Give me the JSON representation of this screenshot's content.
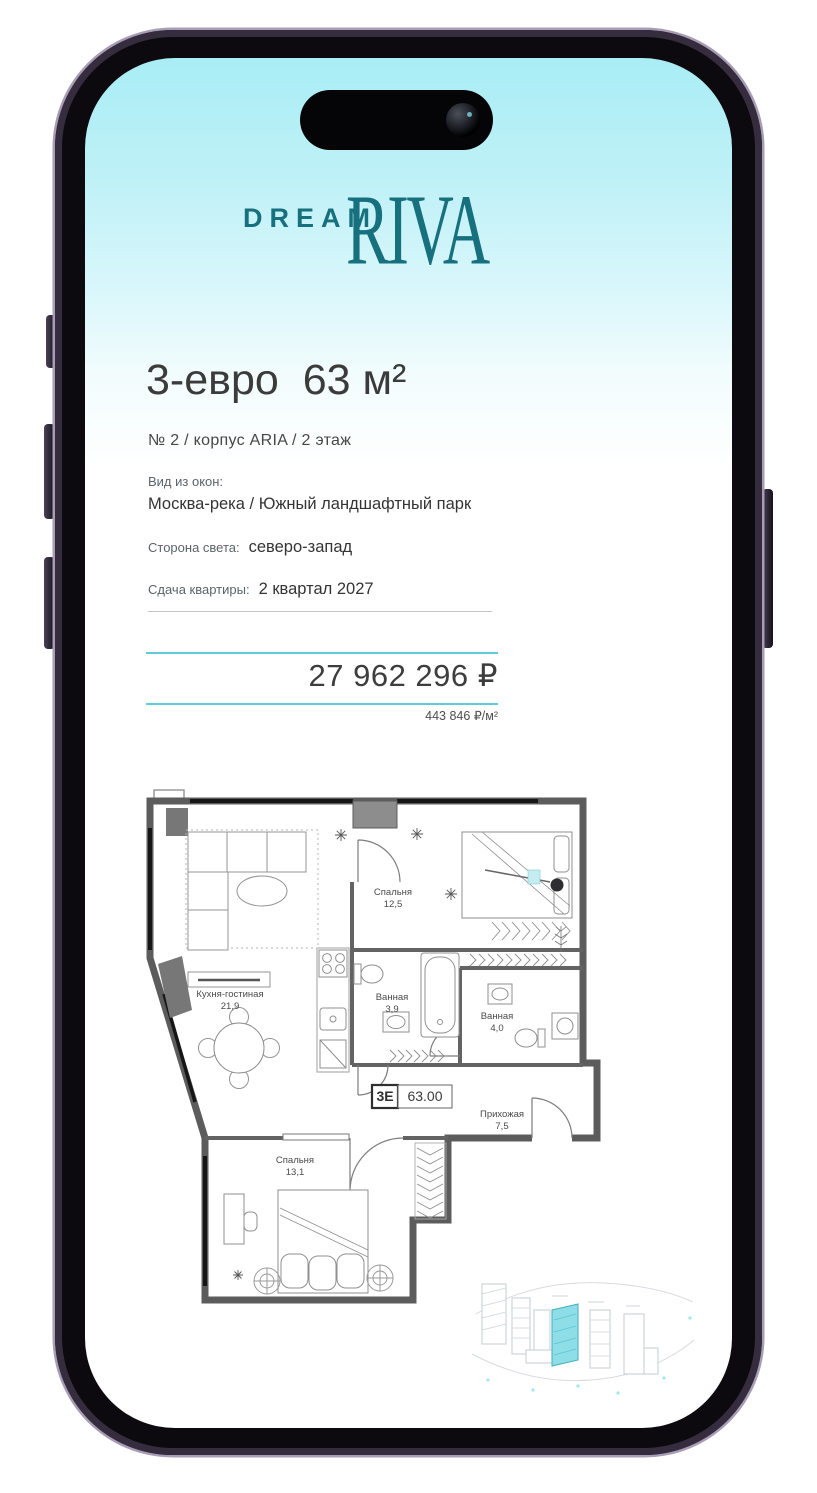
{
  "logo": {
    "dream": "DREAM",
    "riva": "RIVA"
  },
  "listing": {
    "title": "3-евро  63 м²",
    "subtitle": "№ 2 / корпус ARIA / 2 этаж",
    "view_label": "Вид из окон:",
    "view_value": "Москва-река / Южный ландшафтный парк",
    "cardinal_label": "Сторона света:",
    "cardinal_value": "северо-запад",
    "delivery_label": "Сдача квартиры:",
    "delivery_value": "2 квартал 2027",
    "price": "27 962 296 ₽",
    "price_per_m2": "443 846 ₽/м²"
  },
  "floorplan": {
    "unit_type": "3Е",
    "unit_area": "63.00",
    "rooms": [
      {
        "name": "Спальня",
        "area": "12,5"
      },
      {
        "name": "Кухня-гостиная",
        "area": "21,9"
      },
      {
        "name": "Ванная",
        "area": "3,9"
      },
      {
        "name": "Ванная",
        "area": "4,0"
      },
      {
        "name": "Прихожая",
        "area": "7,5"
      },
      {
        "name": "Спальня",
        "area": "13,1"
      }
    ]
  },
  "colors": {
    "brand_teal": "#17707e",
    "accent_line": "#5fccd9",
    "highlight_building": "#8edee7",
    "screen_gradient_top": "#a9edf5"
  }
}
